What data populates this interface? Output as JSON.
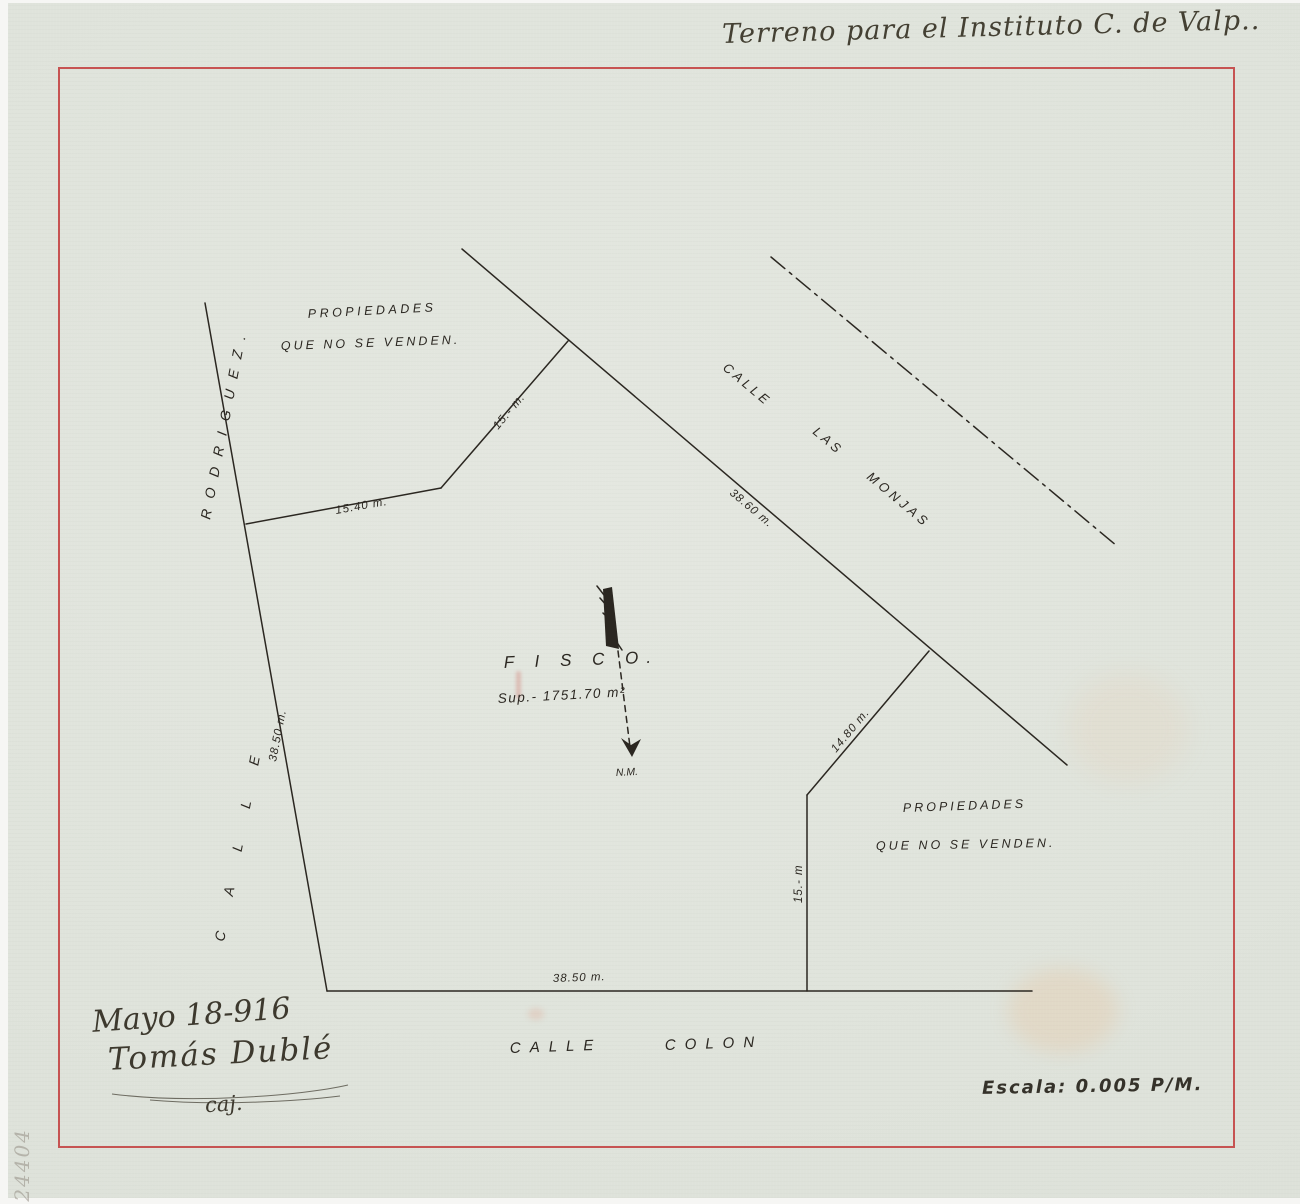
{
  "colors": {
    "paper": "#e0e4dc",
    "ink": "#2b2721",
    "red_border": "#c23a3a",
    "pencil": "#8d867c"
  },
  "header": {
    "handwritten_title": "Terreno para el Instituto C. de Valp.."
  },
  "map": {
    "streets": {
      "rodriguez": {
        "word1": "CALLE",
        "word2": "RODRIGUEZ."
      },
      "las_monjas": {
        "word1": "CALLE",
        "word2": "LAS",
        "word3": "MONJAS"
      },
      "colon": {
        "word1": "CALLE",
        "word2": "COLON"
      }
    },
    "parcel": {
      "name": "F I S C O.",
      "area": "Sup.- 1751.70 m²"
    },
    "north_arrow_label": "N.M.",
    "notes": {
      "top_left_line1": "PROPIEDADES",
      "top_left_line2": "QUE NO SE VENDEN.",
      "bottom_right_line1": "PROPIEDADES",
      "bottom_right_line2": "QUE NO SE VENDEN."
    },
    "measurements": {
      "top_jog": "15.40 m.",
      "top_diagonal": "15.- m.",
      "las_monjas_frontage": "38.60 m.",
      "rodriguez_frontage": "38.50 m.",
      "right_diagonal": "14.80 m.",
      "right_side": "15.- m",
      "colon_frontage": "38.50 m."
    }
  },
  "footer": {
    "date": "Mayo 18-916",
    "signature": "Tomás Dublé",
    "signature_note": "caj.",
    "scale": "Escala: 0.005 P/M."
  },
  "margin": {
    "archive_number": "24404"
  }
}
